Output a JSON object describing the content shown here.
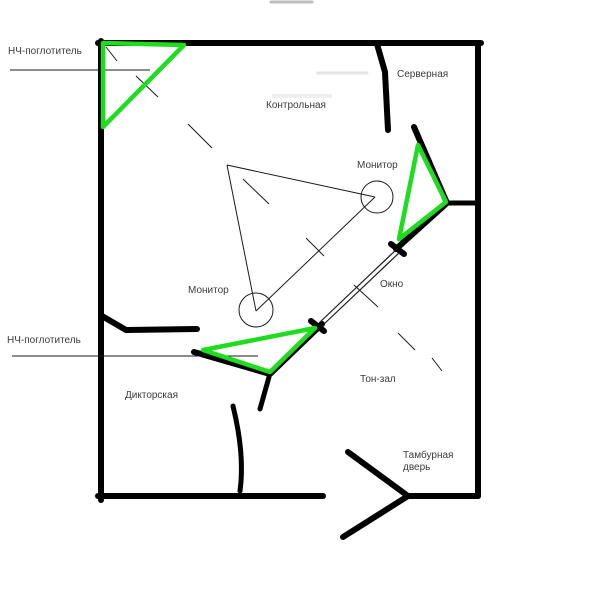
{
  "diagram": {
    "title": "studio-floor-plan",
    "labels": {
      "lf_absorber_top": "НЧ-поглотитель",
      "server_room": "Серверная",
      "control_room": "Контрольная",
      "monitor_top": "Монитор",
      "window": "Окно",
      "monitor_bottom": "Монитор",
      "lf_absorber_bottom": "НЧ-поглотитель",
      "announcer_room": "Дикторская",
      "live_room": "Тон-зал",
      "vestibule_door_line1": "Тамбурная",
      "vestibule_door_line2": "дверь"
    },
    "colors": {
      "wall": "#000000",
      "absorber_green": "#1edc1e",
      "thin_line": "#1a1a1a",
      "text": "#3b3b3b",
      "background": "#ffffff"
    }
  }
}
